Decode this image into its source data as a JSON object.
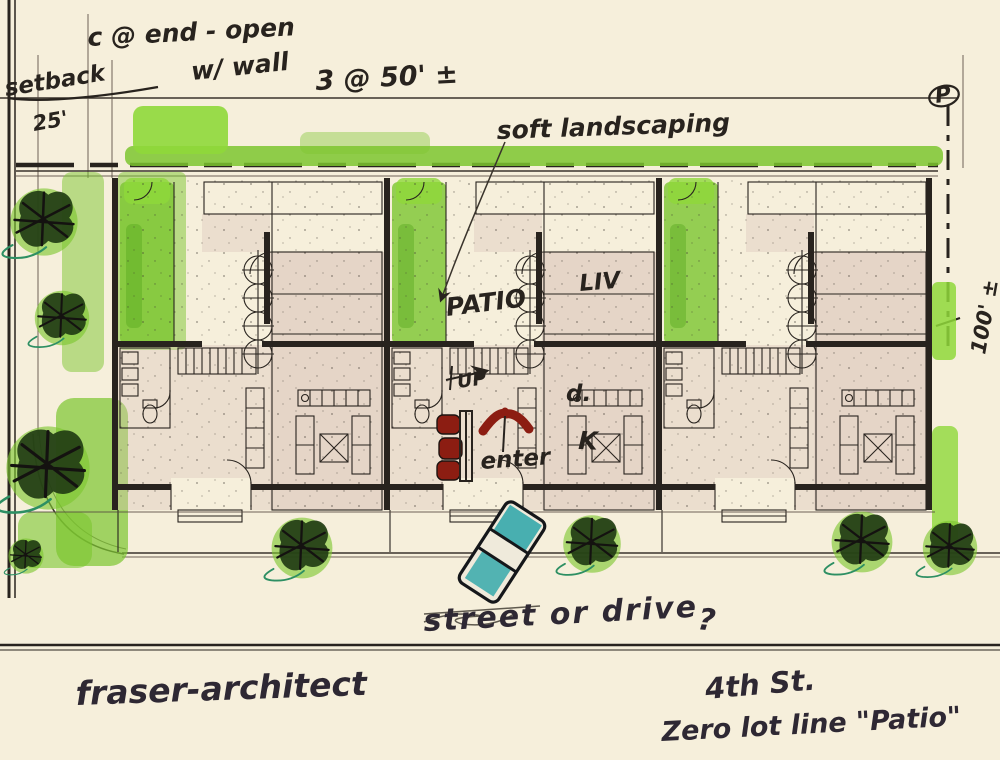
{
  "annotations": {
    "top_left": {
      "end_condition": "c @ end - open",
      "setback": "setback",
      "setback_dim": "25'",
      "wall_note": "w/ wall",
      "bay_dim": "3 @ 50' ±"
    },
    "rear": {
      "landscaping": "soft landscaping"
    },
    "plan_labels": {
      "patio": "PATIO",
      "living": "LIV",
      "up": "UP",
      "dining": "d.",
      "kitchen": "K",
      "enter": "enter"
    },
    "right": {
      "lot_depth": "100' ±",
      "property_pin": "P"
    },
    "bottom": {
      "street_note": "street or drive",
      "question": "?",
      "signature": "fraser-architect",
      "street_name": "4th St.",
      "scheme_name": "Zero lot line \"Patio\""
    }
  },
  "palette": {
    "paper": "#f6efdb",
    "ink": "#28231e",
    "pencil": "#55493f",
    "marker_green": "#7cc62f",
    "marker_green_bright": "#8fd83a",
    "marker_green_dark": "#58a81f",
    "tree_green": "#223d14",
    "wash_pink": "#d9c2b8",
    "accent_red": "#8c1d12",
    "accent_teal": "#2aa5a8"
  }
}
